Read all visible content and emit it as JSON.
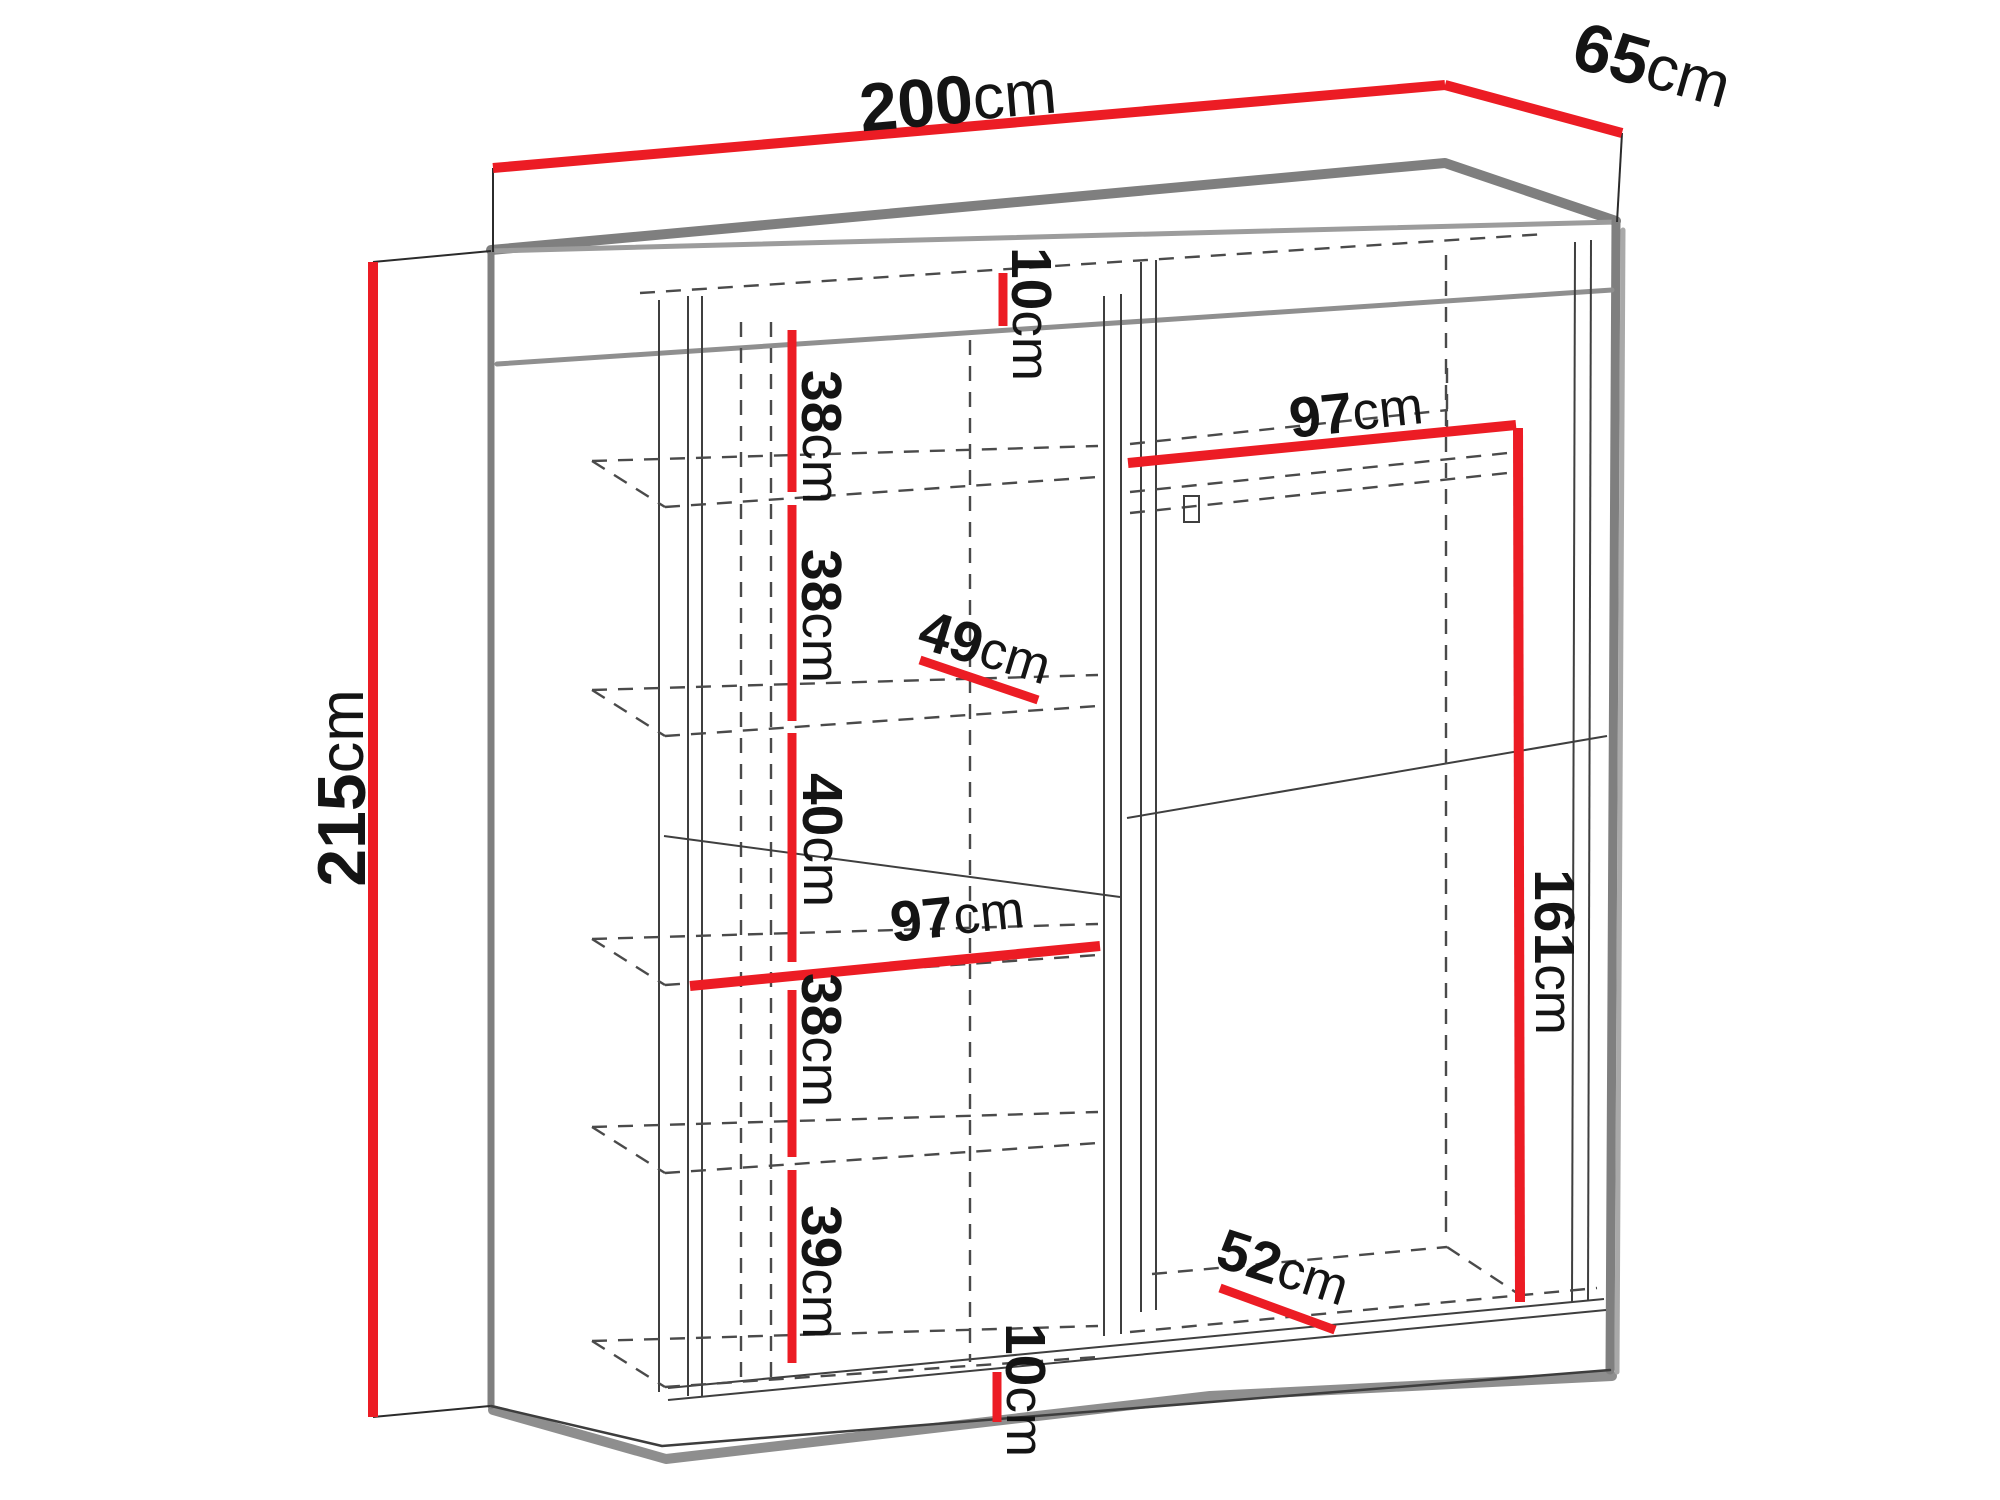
{
  "diagram": {
    "type": "furniture-dimension-drawing",
    "object": "sliding-door wardrobe, perspective view with interior shelving",
    "colors": {
      "accent": "#ec1c24",
      "edges": "#7f7f7f",
      "dashes": "#4a4a4a",
      "text": "#141414",
      "background": "#ffffff"
    }
  },
  "dimensions": [
    {
      "name": "width",
      "value": "200",
      "unit": "cm",
      "description": "overall width (top)"
    },
    {
      "name": "depth",
      "value": "65",
      "unit": "cm",
      "description": "overall depth (top right)"
    },
    {
      "name": "height",
      "value": "215",
      "unit": "cm",
      "description": "overall height (left side)"
    },
    {
      "name": "top-gap",
      "value": "10",
      "unit": "cm",
      "description": "top panel / header height"
    },
    {
      "name": "shelf-space-1",
      "value": "38",
      "unit": "cm",
      "description": "first shelf spacing"
    },
    {
      "name": "shelf-space-2",
      "value": "38",
      "unit": "cm",
      "description": "second shelf spacing"
    },
    {
      "name": "shelf-depth-left",
      "value": "49",
      "unit": "cm",
      "description": "left shelf depth"
    },
    {
      "name": "shelf-space-3",
      "value": "40",
      "unit": "cm",
      "description": "third shelf spacing"
    },
    {
      "name": "left-width",
      "value": "97",
      "unit": "cm",
      "description": "left compartment width"
    },
    {
      "name": "shelf-space-4",
      "value": "38",
      "unit": "cm",
      "description": "fourth shelf spacing"
    },
    {
      "name": "shelf-space-5",
      "value": "39",
      "unit": "cm",
      "description": "fifth shelf spacing"
    },
    {
      "name": "bottom-gap",
      "value": "10",
      "unit": "cm",
      "description": "plinth height"
    },
    {
      "name": "right-width",
      "value": "97",
      "unit": "cm",
      "description": "right compartment width"
    },
    {
      "name": "hanging-height",
      "value": "161",
      "unit": "cm",
      "description": "hanging space height"
    },
    {
      "name": "shelf-depth-right",
      "value": "52",
      "unit": "cm",
      "description": "right bottom shelf depth"
    }
  ]
}
